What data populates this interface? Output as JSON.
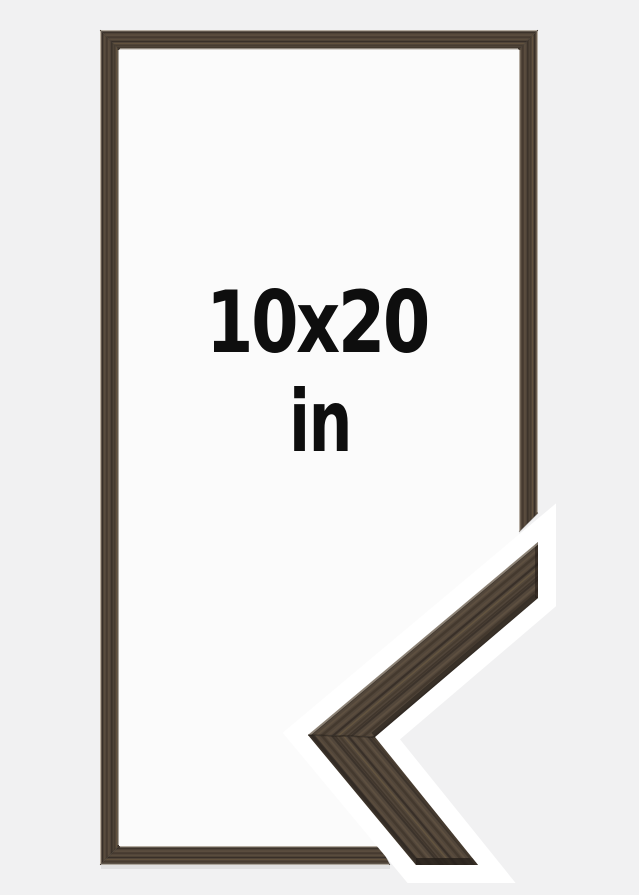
{
  "product_image": {
    "size_label": {
      "line1": "10x20",
      "line2": "in"
    }
  },
  "colors": {
    "page_background": "#f1f1f2",
    "frame_opening": "#fbfbfb",
    "sample_outline": "#ffffff",
    "wood_base": "#52463a",
    "wood_grain_dark": "#3a312a",
    "wood_grain_light": "#63543f",
    "wood_edge_highlight": "#ece6db",
    "label_text": "#0e0e0e"
  }
}
